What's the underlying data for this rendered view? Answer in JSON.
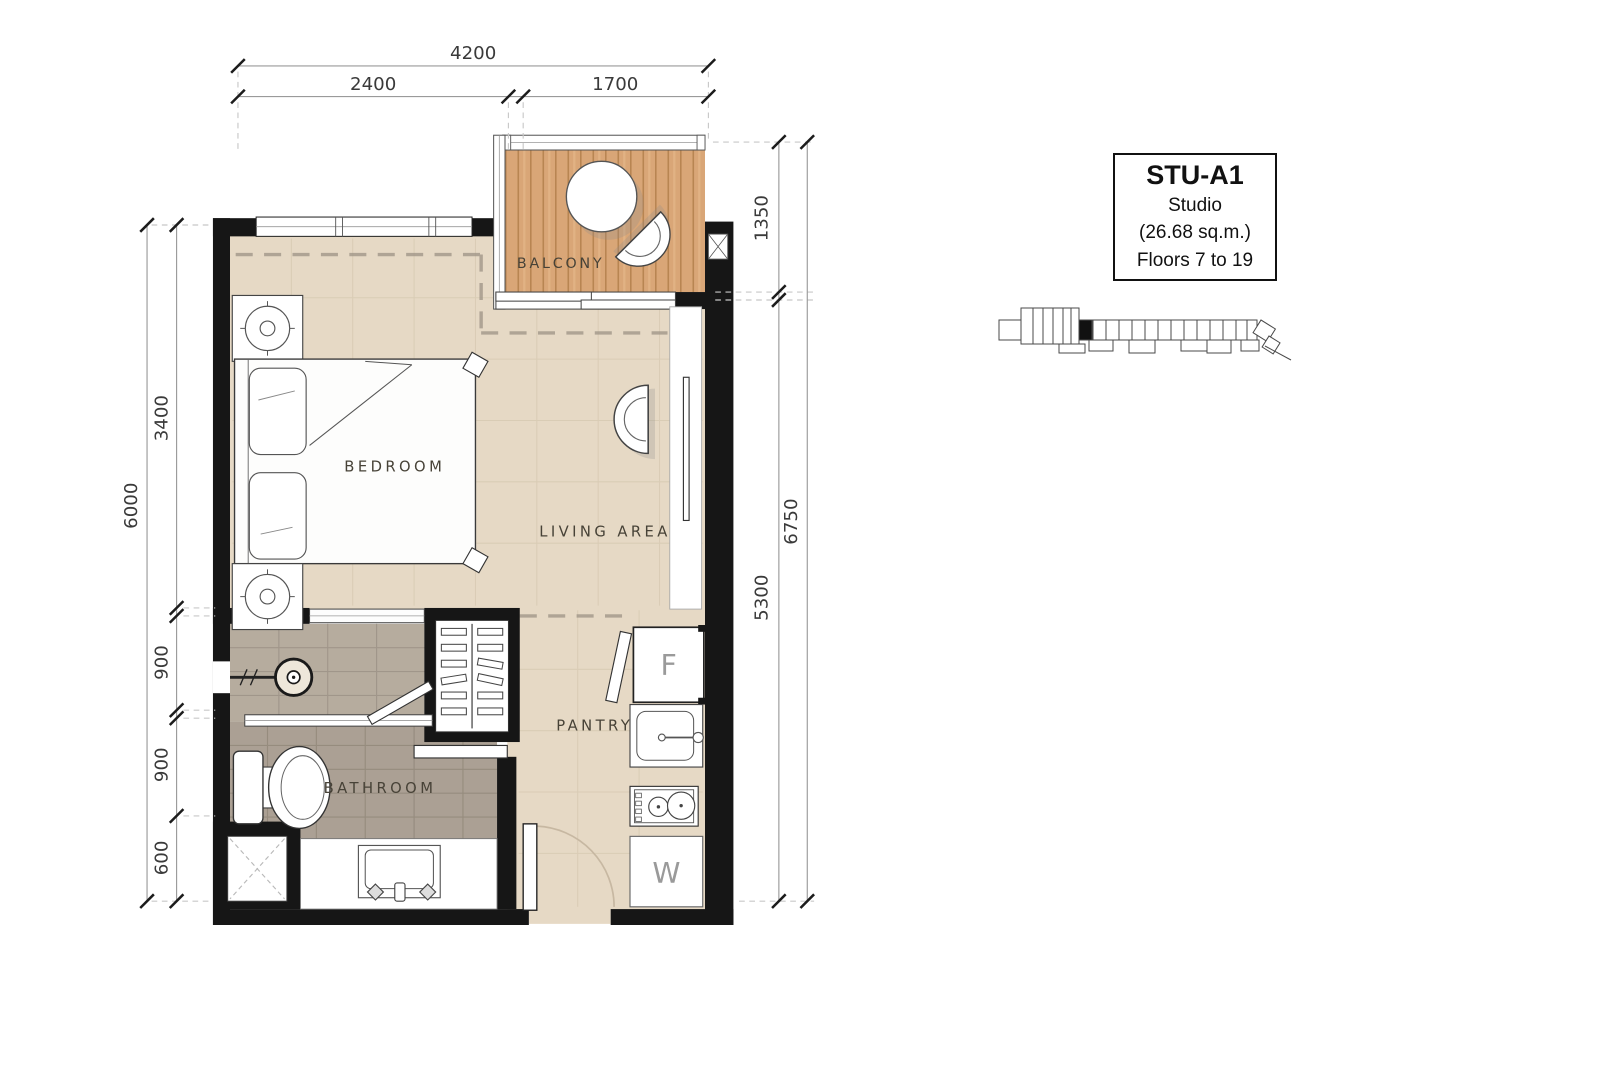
{
  "title_block": {
    "unit_code": "STU-A1",
    "unit_type": "Studio",
    "unit_area": "(26.68 sq.m.)",
    "unit_floors": "Floors 7 to 19"
  },
  "rooms": {
    "balcony": "BALCONY",
    "bedroom": "BEDROOM",
    "living": "LIVING AREA",
    "pantry": "PANTRY",
    "bathroom": "BATHROOM"
  },
  "appliances": {
    "fridge": "F",
    "washer": "W"
  },
  "dimensions": {
    "top": {
      "overall": "4200",
      "left": "2400",
      "right": "1700"
    },
    "left": {
      "overall": "6000",
      "segments": [
        "3400",
        "900",
        "900",
        "600"
      ]
    },
    "right": {
      "overall": "6750",
      "upper": "1350",
      "lower": "5300"
    }
  },
  "colors": {
    "wall": "#161616",
    "floor": "#e6d9c5",
    "balcony_wood": "#d9a677",
    "bathroom_tile_upper": "#b6ac9e",
    "bathroom_tile_lower": "#aba094",
    "dimension_text": "#3a3a3a",
    "label_text": "#474237"
  }
}
